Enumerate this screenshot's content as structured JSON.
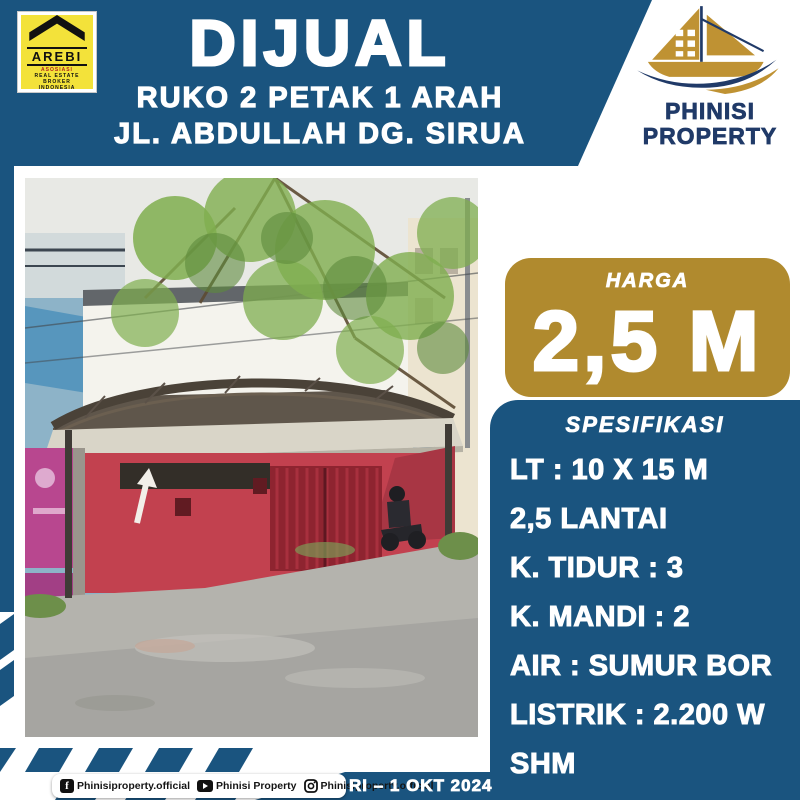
{
  "colors": {
    "navy": "#1a547f",
    "gold": "#b08a2e",
    "arebi_yellow": "#f3e23a",
    "logo_navy": "#203a68",
    "logo_gold": "#bf9233"
  },
  "header": {
    "badge": "AREBI",
    "badge_rows": [
      "ASOSIASI",
      "REAL ESTATE BROKER",
      "INDONESIA"
    ],
    "title": "DIJUAL",
    "subtitle_line1": "RUKO 2 PETAK 1 ARAH",
    "subtitle_line2": "JL. ABDULLAH DG. SIRUA"
  },
  "brand": {
    "line1": "PHINISI",
    "line2": "PROPERTY"
  },
  "price": {
    "label": "HARGA",
    "value": "2,5 M"
  },
  "specs": {
    "title": "SPESIFIKASI",
    "items": [
      "LT : 10 X 15 M",
      "2,5 LANTAI",
      "K. TIDUR : 3",
      "K. MANDI : 2",
      "AIR : SUMUR BOR",
      "LISTRIK : 2.200 W",
      "SHM"
    ]
  },
  "footer": {
    "socials": [
      {
        "icon": "facebook-icon",
        "label": "Phinisiproperty.official"
      },
      {
        "icon": "youtube-icon",
        "label": "Phinisi Property"
      },
      {
        "icon": "instagram-icon",
        "label": "Phinisiproperty.official"
      }
    ],
    "date": "RI – 1 OKT 2024"
  }
}
